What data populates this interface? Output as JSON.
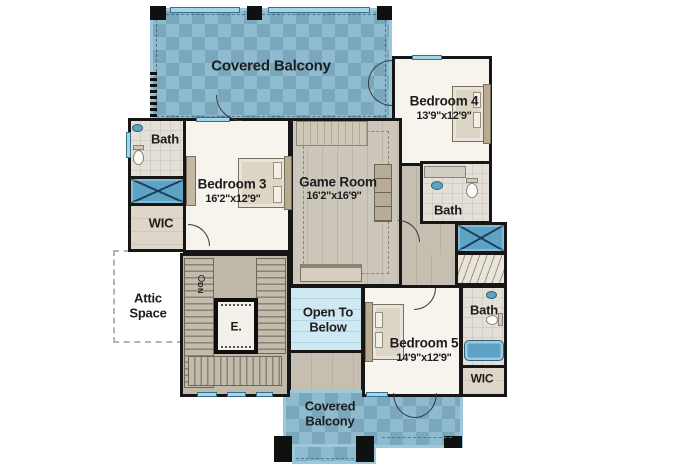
{
  "plan": {
    "rooms": {
      "covered_balcony_top": {
        "label": "Covered Balcony"
      },
      "bedroom_4": {
        "label": "Bedroom 4",
        "dims": "13'9\"x12'9\""
      },
      "bath_upper": {
        "label": "Bath"
      },
      "bedroom_3": {
        "label": "Bedroom 3",
        "dims": "16'2\"x12'9\""
      },
      "game_room": {
        "label": "Game Room",
        "dims": "16'2\"x16'9\""
      },
      "wic_left": {
        "label": "WIC"
      },
      "bath_middle": {
        "label": "Bath"
      },
      "attic_space": {
        "line1": "Attic",
        "line2": "Space"
      },
      "stairs": {
        "down_label": "DN"
      },
      "elevator": {
        "label": "E."
      },
      "open_to_below": {
        "line1": "Open To",
        "line2": "Below"
      },
      "bedroom_5": {
        "label": "Bedroom 5",
        "dims": "14'9\"x12'9\""
      },
      "bath_lower": {
        "label": "Bath"
      },
      "wic_right": {
        "label": "WIC"
      },
      "covered_balcony_bottom": {
        "line1": "Covered",
        "line2": "Balcony"
      }
    },
    "colors": {
      "balcony_tile": "#87b7cd",
      "open_below": "#cfe9f2",
      "fixture_blue": "#5ea3c6",
      "wall": "#161616",
      "room_floor": "#f7f4ed",
      "hall_floor": "#c6bfb1",
      "game_floor": "#ccc6bb",
      "bath_floor": "#e4e0d8",
      "wic_floor": "#ded7c9",
      "stair_floor": "#c0b8a9",
      "text": "#1d1d1d"
    }
  }
}
